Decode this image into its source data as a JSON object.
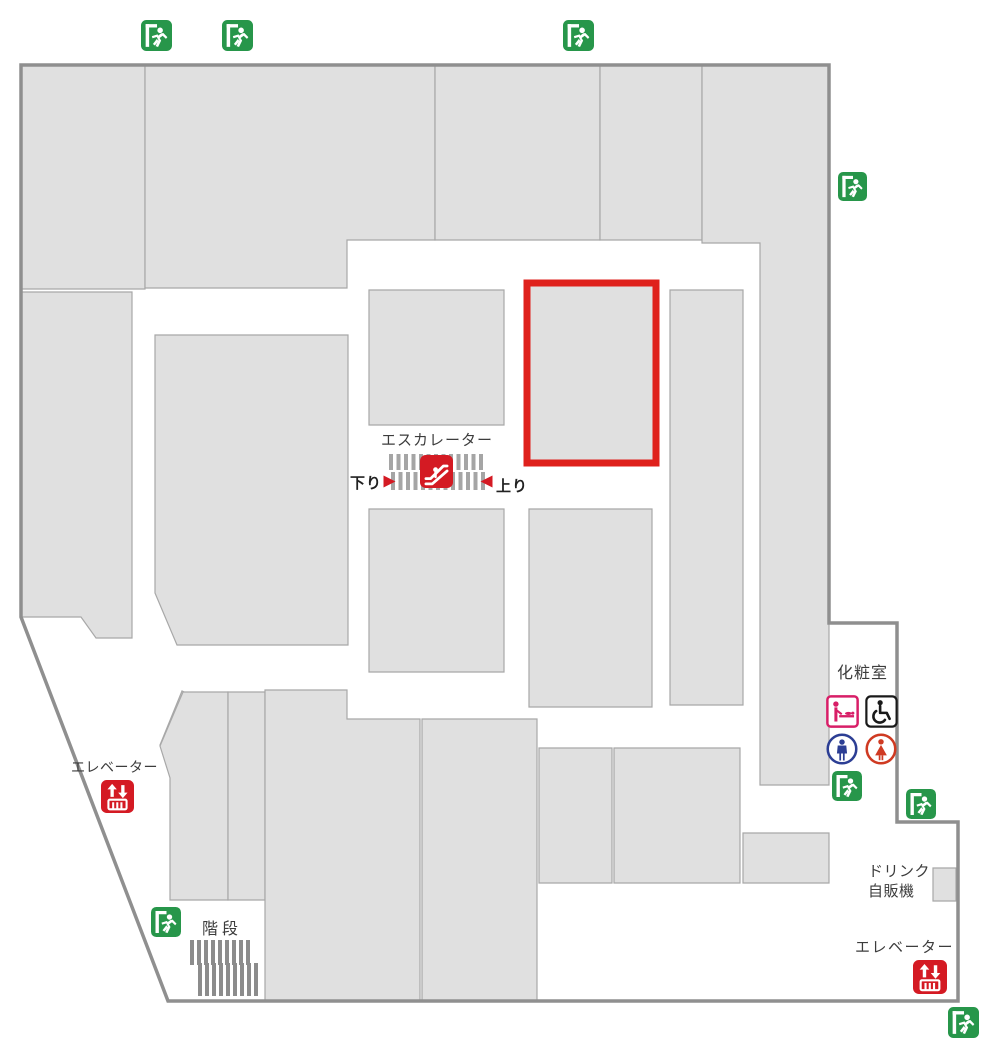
{
  "labels": {
    "escalator": "エスカレーター",
    "escalator_down": "下り",
    "escalator_up": "上り",
    "elevator_left": "エレベーター",
    "elevator_right": "エレベーター",
    "stairs": "階段",
    "restroom": "化粧室",
    "vending_line1": "ドリンク",
    "vending_line2": "自販機"
  },
  "colors": {
    "exit_green": "#27964a",
    "icon_red": "#d41a23",
    "highlight_red": "#df211c",
    "block_fill": "#e0e0e0",
    "block_border": "#a8a8a8",
    "wall": "#8f8f8f",
    "baby_pink": "#d81e67",
    "mens_blue": "#2c3e94",
    "womens_red": "#cf3a22",
    "text": "#3c3c3c"
  },
  "map": {
    "width": 1000,
    "height": 1057,
    "wall_path": "M21 65 H829 V623 H897 V822 H958 V1001 H168 L21 617 Z",
    "blocks": [
      [
        [
          21,
          65
        ],
        [
          145,
          65
        ],
        [
          145,
          289
        ],
        [
          21,
          289
        ]
      ],
      [
        [
          145,
          65
        ],
        [
          435,
          65
        ],
        [
          435,
          240
        ],
        [
          347,
          240
        ],
        [
          347,
          288
        ],
        [
          145,
          288
        ]
      ],
      [
        [
          435,
          65
        ],
        [
          600,
          65
        ],
        [
          600,
          240
        ],
        [
          435,
          240
        ]
      ],
      [
        [
          600,
          65
        ],
        [
          702,
          65
        ],
        [
          702,
          240
        ],
        [
          600,
          240
        ]
      ],
      [
        [
          702,
          65
        ],
        [
          829,
          65
        ],
        [
          829,
          785
        ],
        [
          760,
          785
        ],
        [
          760,
          243
        ],
        [
          702,
          243
        ]
      ],
      [
        [
          21,
          292
        ],
        [
          132,
          292
        ],
        [
          132,
          638
        ],
        [
          96,
          638
        ],
        [
          81,
          617
        ],
        [
          21,
          617
        ]
      ],
      [
        [
          155,
          335
        ],
        [
          348,
          335
        ],
        [
          348,
          645
        ],
        [
          177,
          645
        ],
        [
          155,
          593
        ]
      ],
      [
        [
          369,
          290
        ],
        [
          504,
          290
        ],
        [
          504,
          425
        ],
        [
          369,
          425
        ]
      ],
      [
        [
          670,
          290
        ],
        [
          743,
          290
        ],
        [
          743,
          705
        ],
        [
          670,
          705
        ]
      ],
      [
        [
          369,
          509
        ],
        [
          504,
          509
        ],
        [
          504,
          672
        ],
        [
          369,
          672
        ]
      ],
      [
        [
          529,
          509
        ],
        [
          652,
          509
        ],
        [
          652,
          707
        ],
        [
          529,
          707
        ]
      ],
      [
        [
          160,
          745
        ],
        [
          182,
          691
        ],
        [
          205,
          702
        ],
        [
          183,
          756
        ]
      ],
      [
        [
          183,
          692
        ],
        [
          228,
          692
        ],
        [
          228,
          900
        ],
        [
          170,
          900
        ],
        [
          170,
          778
        ],
        [
          160,
          746
        ]
      ],
      [
        [
          228,
          692
        ],
        [
          265,
          692
        ],
        [
          265,
          900
        ],
        [
          228,
          900
        ]
      ],
      [
        [
          265,
          690
        ],
        [
          347,
          690
        ],
        [
          347,
          719
        ],
        [
          420,
          719
        ],
        [
          420,
          1001
        ],
        [
          265,
          1001
        ]
      ],
      [
        [
          422,
          719
        ],
        [
          537,
          719
        ],
        [
          537,
          1001
        ],
        [
          422,
          1001
        ]
      ],
      [
        [
          539,
          748
        ],
        [
          612,
          748
        ],
        [
          612,
          883
        ],
        [
          539,
          883
        ]
      ],
      [
        [
          614,
          748
        ],
        [
          740,
          748
        ],
        [
          740,
          883
        ],
        [
          614,
          883
        ]
      ],
      [
        [
          743,
          833
        ],
        [
          829,
          833
        ],
        [
          829,
          883
        ],
        [
          743,
          883
        ]
      ],
      [
        [
          933,
          868
        ],
        [
          956,
          868
        ],
        [
          956,
          901
        ],
        [
          933,
          901
        ]
      ]
    ],
    "highlight_block": [
      [
        527,
        283
      ],
      [
        656,
        283
      ],
      [
        656,
        463
      ],
      [
        527,
        463
      ]
    ],
    "hatches": [
      {
        "name": "escalator-hatch-top",
        "x": 389,
        "y": 454,
        "w": 95,
        "h": 16,
        "bar": 4,
        "pitch": 7.5,
        "color": "#a5a5a5"
      },
      {
        "name": "escalator-hatch-bottom",
        "x": 391,
        "y": 472,
        "w": 95,
        "h": 18,
        "bar": 4,
        "pitch": 7.5,
        "color": "#a5a5a5"
      },
      {
        "name": "stairs-hatch-top",
        "x": 190,
        "y": 940,
        "w": 62,
        "h": 25,
        "bar": 4,
        "pitch": 7,
        "color": "#8c8c8c"
      },
      {
        "name": "stairs-hatch-bottom",
        "x": 198,
        "y": 963,
        "w": 62,
        "h": 33,
        "bar": 4,
        "pitch": 7,
        "color": "#8c8c8c"
      }
    ],
    "icons": [
      {
        "sym": "exit",
        "name": "emergency-exit-icon",
        "x": 141,
        "y": 20,
        "s": 31
      },
      {
        "sym": "exit",
        "name": "emergency-exit-icon",
        "x": 222,
        "y": 20,
        "s": 31
      },
      {
        "sym": "exit",
        "name": "emergency-exit-icon",
        "x": 563,
        "y": 20,
        "s": 31
      },
      {
        "sym": "exit",
        "name": "emergency-exit-icon",
        "x": 838,
        "y": 172,
        "s": 29
      },
      {
        "sym": "exit",
        "name": "emergency-exit-icon",
        "x": 832,
        "y": 771,
        "s": 30
      },
      {
        "sym": "exit",
        "name": "emergency-exit-icon",
        "x": 906,
        "y": 789,
        "s": 30
      },
      {
        "sym": "exit",
        "name": "emergency-exit-icon",
        "x": 151,
        "y": 907,
        "s": 30
      },
      {
        "sym": "exit",
        "name": "emergency-exit-icon",
        "x": 948,
        "y": 1007,
        "s": 31
      },
      {
        "sym": "escalator",
        "name": "escalator-icon",
        "x": 420,
        "y": 455,
        "s": 33
      },
      {
        "sym": "elevator",
        "name": "elevator-icon",
        "x": 101,
        "y": 780,
        "s": 33
      },
      {
        "sym": "elevator",
        "name": "elevator-icon",
        "x": 913,
        "y": 960,
        "s": 34
      },
      {
        "sym": "baby",
        "name": "baby-changing-icon",
        "x": 826,
        "y": 695,
        "s": 33
      },
      {
        "sym": "wheelchair",
        "name": "wheelchair-accessible-icon",
        "x": 865,
        "y": 695,
        "s": 33
      },
      {
        "sym": "men",
        "name": "mens-restroom-icon",
        "x": 826,
        "y": 733,
        "s": 32
      },
      {
        "sym": "women",
        "name": "womens-restroom-icon",
        "x": 865,
        "y": 733,
        "s": 32
      },
      {
        "sym": "tri-r",
        "name": "down-direction-arrow-icon",
        "x": 383,
        "y": 475,
        "s": 13
      },
      {
        "sym": "tri-l",
        "name": "up-direction-arrow-icon",
        "x": 480,
        "y": 475,
        "s": 13
      }
    ]
  }
}
